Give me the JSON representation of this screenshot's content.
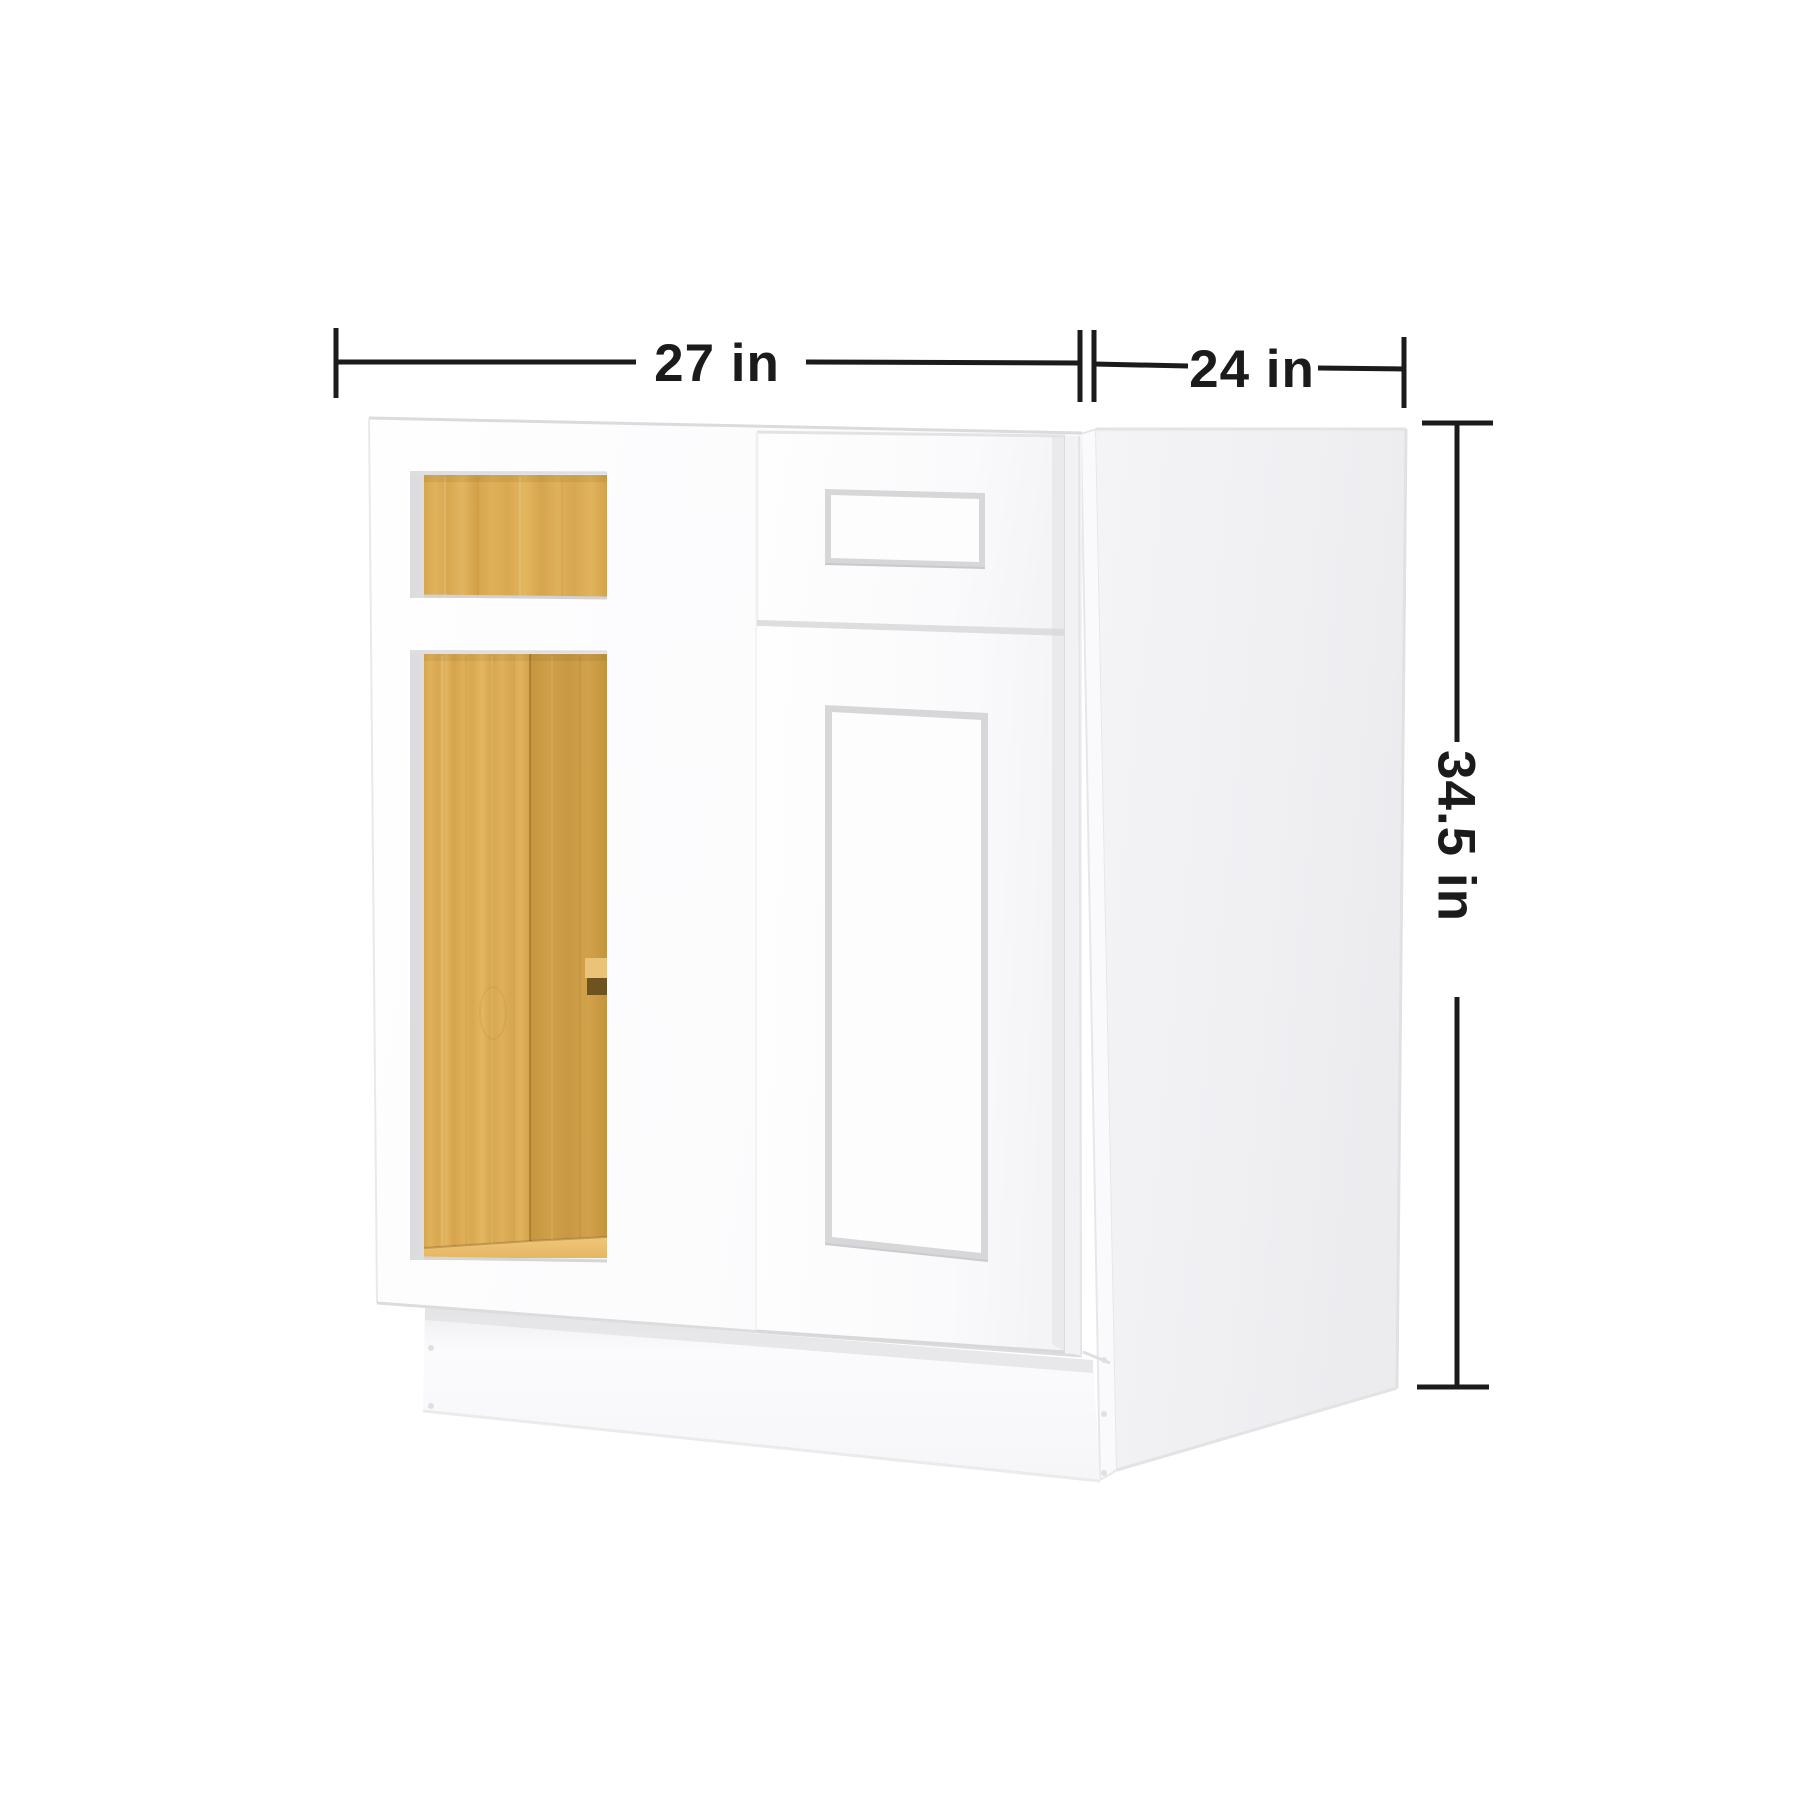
{
  "canvas": {
    "background": "#ffffff"
  },
  "dimensions": {
    "width": {
      "label": "27 in"
    },
    "depth": {
      "label": "24 in"
    },
    "height": {
      "label": "34.5 in"
    }
  },
  "colors": {
    "dimension_line": "#1b1b1b",
    "dimension_text": "#1b1b1b",
    "cabinet_white": "#fdfdfe",
    "side_panel_gray": "#f1f1f3",
    "wood_base": "#dcab55",
    "wood_dark": "#cb9b45",
    "wood_floor": "#ecc06e",
    "bracket_light": "#eac278",
    "bracket_shadow": "#6e5220",
    "recess_line": "#d7d7da"
  }
}
